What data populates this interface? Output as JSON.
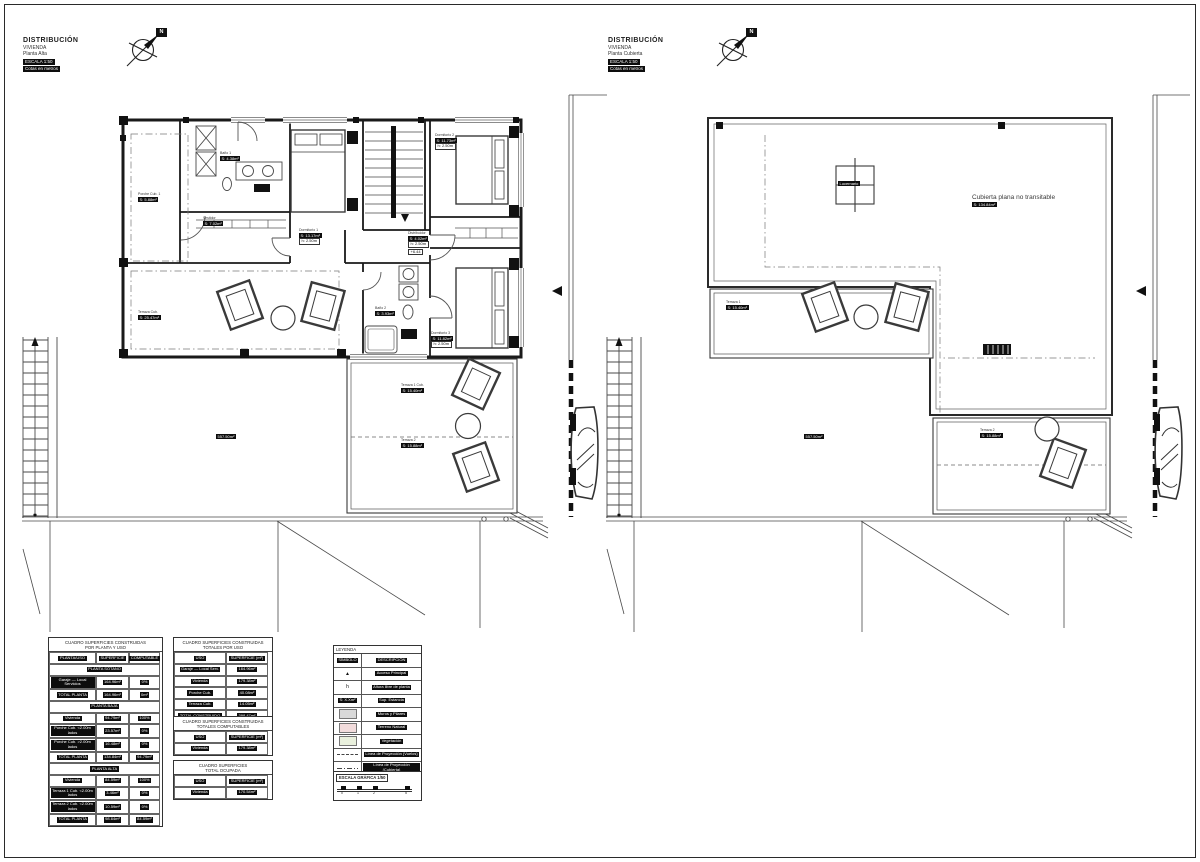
{
  "titles": {
    "left": {
      "l1": "DISTRIBUCIÓN",
      "l2": "VIVIENDA",
      "l3": "Planta Alta",
      "bar1": "ESCALA 1:50",
      "bar2": "Cotas en metros"
    },
    "right": {
      "l1": "DISTRIBUCIÓN",
      "l2": "VIVIENDA",
      "l3": "Planta Cubierta",
      "bar1": "ESCALA 1:50",
      "bar2": "Cotas en metros"
    },
    "compass_letter": "N"
  },
  "plan_left": {
    "porche": {
      "name": "Porche Cub. 1",
      "area": "S: 5.88m²"
    },
    "terraza_cub": {
      "name": "Terraza Cub.",
      "area": "S: 25.47m²"
    },
    "dorm1": {
      "name": "Dormitorio 1",
      "area": "S: 13.17m²",
      "h": "h: 2.50m"
    },
    "dorm2": {
      "name": "Dormitorio 2",
      "area": "S: 11.73m²",
      "h": "h: 2.50m"
    },
    "dorm3": {
      "name": "Dormitorio 3",
      "area": "S: 11.82m²",
      "h": "h: 2.50m"
    },
    "banyo1": {
      "name": "Baño 1",
      "area": "S: 4.38m²"
    },
    "banyo2": {
      "name": "Baño 2",
      "area": "S: 3.93m²"
    },
    "vestidor": {
      "name": "Vestidor",
      "area": "S: 7.02m²"
    },
    "distribuidor": {
      "name": "Distribuidor",
      "area": "S: 4.02m²",
      "h": "h: 2.50m",
      "cota": "+6.44"
    },
    "terraza1": {
      "name": "Terraza 1 Cub.",
      "area": "S: 15.40m²"
    },
    "terraza2": {
      "name": "Terraza 2",
      "area": "S: 15.88m²"
    },
    "parcela": {
      "area": "557.50m²"
    }
  },
  "plan_right": {
    "lucernario": "Lucernario",
    "roof_note": "Cubierta plana no transitable",
    "roof_area": "S: 134.84m²",
    "terraza1": {
      "name": "Terraza 1",
      "area": "S: 15.40m²"
    },
    "terraza2": {
      "name": "Terraza 2",
      "area": "S: 15.88m²"
    },
    "parcela": "557.50m²"
  },
  "tables": {
    "t1": {
      "title1": "CUADRO SUPERFICIES CONSTRUIDAS",
      "title2": "POR PLANTA Y USO",
      "h0": "PLANTA/USO",
      "h1": "SUPERFICIE",
      "h2": "COMPUTABLE",
      "rows": [
        {
          "sec": "PLANTA SÓTANO"
        },
        {
          "c0": "Garaje — Local Servicios",
          "c1": "164.96m²",
          "c2": "0%"
        },
        {
          "c0": "TOTAL PLANTA",
          "c1": "164.96m²",
          "c2": "0m²"
        },
        {
          "sec": "PLANTA BAJA"
        },
        {
          "c0": "Vivienda",
          "c1": "94.79m²",
          "c2": "100%"
        },
        {
          "c0": "Porche Cub. <2.00m lados",
          "c1": "23.57m²",
          "c2": "0%"
        },
        {
          "c0": "Porche Cub. >2.00m lados",
          "c1": "16.48m²",
          "c2": "0%"
        },
        {
          "c0": "TOTAL PLANTA",
          "c1": "134.84m²",
          "c2": "94.79m²"
        },
        {
          "sec": "PLANTA ALTA"
        },
        {
          "c0": "Vivienda",
          "c1": "84.59m²",
          "c2": "100%"
        },
        {
          "c0": "Terraza 1 Cub. <2.00m lados",
          "c1": "3.46m²",
          "c2": "0%"
        },
        {
          "c0": "Terraza 2 Cub. <2.00m lados",
          "c1": "10.59m²",
          "c2": "0%"
        },
        {
          "c0": "TOTAL PLANTA",
          "c1": "98.64m²",
          "c2": "84.59m²"
        }
      ]
    },
    "t2a": {
      "title1": "CUADRO SUPERFICIES CONSTRUIDAS",
      "title2": "TOTALES POR USO",
      "h0": "USO",
      "h1": "SUPERFICIE (m²)",
      "rows": [
        {
          "c0": "Garaje — Local Serv.",
          "c1": "164.96m²"
        },
        {
          "c0": "Vivienda",
          "c1": "179.38m²"
        },
        {
          "c0": "Porche Cub.",
          "c1": "40.08m²"
        },
        {
          "c0": "Terraza Cub.",
          "c1": "14.05m²"
        },
        {
          "c0": "TOTAL CONSTRUIDO",
          "c1": "398.47m²"
        }
      ]
    },
    "t2b": {
      "title1": "CUADRO SUPERFICIES CONSTRUIDAS",
      "title2": "TOTALES COMPUTABLES",
      "h0": "USO",
      "h1": "SUPERFICIE (m²)",
      "rows": [
        {
          "c0": "Vivienda",
          "c1": "179.38m²"
        }
      ]
    },
    "t2c": {
      "title1": "CUADRO SUPERFICIES",
      "title2": "TOTAL OCUPADA",
      "h0": "USO",
      "h1": "SUPERFICIE (m²)",
      "rows": [
        {
          "c0": "Vivienda",
          "c1": "170.54m²"
        }
      ]
    }
  },
  "legend": {
    "title": "LEYENDA",
    "h0": "SÍMBOLO",
    "h1": "DESCRIPCIÓN",
    "colors": {
      "muros": "#d9d9d9",
      "terreno": "#f2dcdc",
      "vegetacion": "#e9f0dd"
    },
    "rows": [
      {
        "symbol": "▲",
        "desc": "Acceso Principal"
      },
      {
        "symbol": "h",
        "desc": "Altura libre de planta"
      },
      {
        "symbol": "S: X.Xm²",
        "desc": "Sup. Estancia"
      },
      {
        "desc": "Muros y Pilares"
      },
      {
        "desc": "Terreno Natural"
      },
      {
        "desc": "Vegetación"
      },
      {
        "desc": "Línea de Proyección (Vuelos)"
      },
      {
        "desc": "Línea de Proyección (Cubierta)"
      }
    ],
    "escala": {
      "title": "ESCALA GRÁFICA 1/50",
      "t0": "0",
      "t1": "1",
      "t2": "2",
      "t3": "5"
    }
  }
}
